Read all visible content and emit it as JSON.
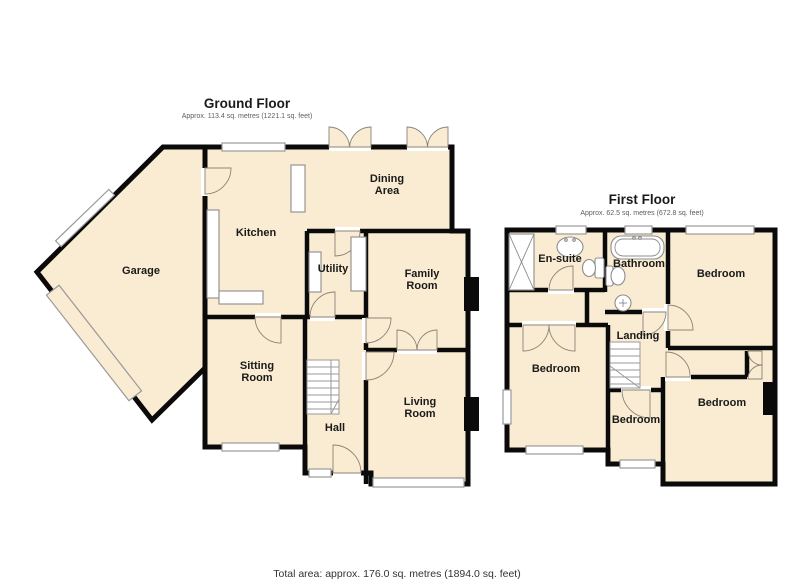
{
  "colors": {
    "room_fill": "#FAECD2",
    "wall": "#0A0A0A",
    "window_fill": "#FFFFFF",
    "window_stroke": "#9A9A9A",
    "door_stroke": "#8A8378",
    "fixture_stroke": "#8C8C8C",
    "label_color": "#1A1A1A",
    "subtitle_color": "#5E5E5E",
    "footer_color": "#333333"
  },
  "ground_floor": {
    "title": "Ground Floor",
    "area_text": "Approx. 113.4 sq. metres (1221.1 sq. feet)",
    "rooms": {
      "garage": "Garage",
      "kitchen": "Kitchen",
      "dining_line1": "Dining",
      "dining_line2": "Area",
      "utility": "Utility",
      "family_line1": "Family",
      "family_line2": "Room",
      "sitting_line1": "Sitting",
      "sitting_line2": "Room",
      "hall": "Hall",
      "living_line1": "Living",
      "living_line2": "Room"
    }
  },
  "first_floor": {
    "title": "First Floor",
    "area_text": "Approx. 62.5 sq. metres (672.8 sq. feet)",
    "rooms": {
      "ensuite": "En-suite",
      "bathroom": "Bathroom",
      "bedroom_top_right": "Bedroom",
      "landing": "Landing",
      "bedroom_left": "Bedroom",
      "bedroom_middle": "Bedroom",
      "bedroom_bottom_right": "Bedroom"
    }
  },
  "footer": {
    "total_area_text": "Total area: approx. 176.0 sq. metres (1894.0 sq. feet)"
  }
}
